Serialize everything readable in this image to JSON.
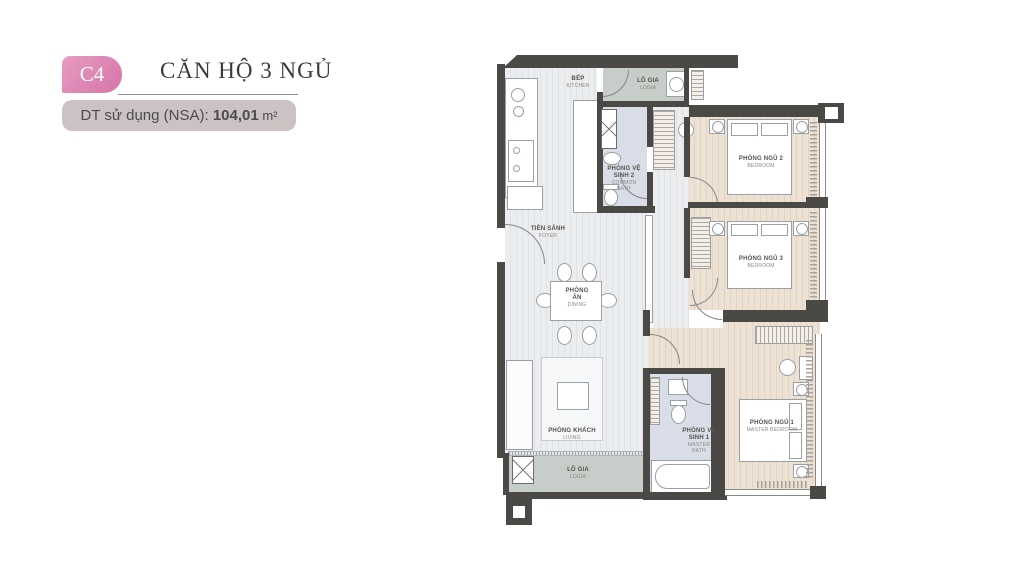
{
  "header": {
    "badge": "C4",
    "title": "CĂN HỘ 3 NGỦ",
    "area_label": "DT sử dụng (NSA): ",
    "area_value": "104,01",
    "area_unit": " m²"
  },
  "plan": {
    "rooms": {
      "kitchen": {
        "name": "BẾP",
        "sub": "KITCHEN"
      },
      "logia_top": {
        "name": "LÔ GIA",
        "sub": "LOGIA"
      },
      "bath2": {
        "name": "PHÒNG VỆ SINH 2",
        "sub": "COMMON BATH"
      },
      "foyer": {
        "name": "TIỀN SẢNH",
        "sub": "FOYER"
      },
      "dining": {
        "name": "PHÒNG ĂN",
        "sub": "DINING"
      },
      "living": {
        "name": "PHÒNG KHÁCH",
        "sub": "LIVING"
      },
      "logia_bottom": {
        "name": "LÔ GIA",
        "sub": "LOGIA"
      },
      "bath1": {
        "name": "PHÒNG VỆ SINH 1",
        "sub": "MASTER BATH"
      },
      "bedroom2": {
        "name": "PHÒNG NGỦ 2",
        "sub": "BEDROOM"
      },
      "bedroom3": {
        "name": "PHÒNG NGỦ 3",
        "sub": "BEDROOM"
      },
      "bedroom1": {
        "name": "PHÒNG NGỦ 1",
        "sub": "MASTER BEDROOM"
      }
    },
    "colors": {
      "wall": "#4a4946",
      "floor_wood": "#e9ebed",
      "floor_bedroom": "#eadfd0",
      "floor_bath": "#d8dde7",
      "floor_logia": "#c7cec9",
      "accent_pink": "#db80b2"
    }
  }
}
